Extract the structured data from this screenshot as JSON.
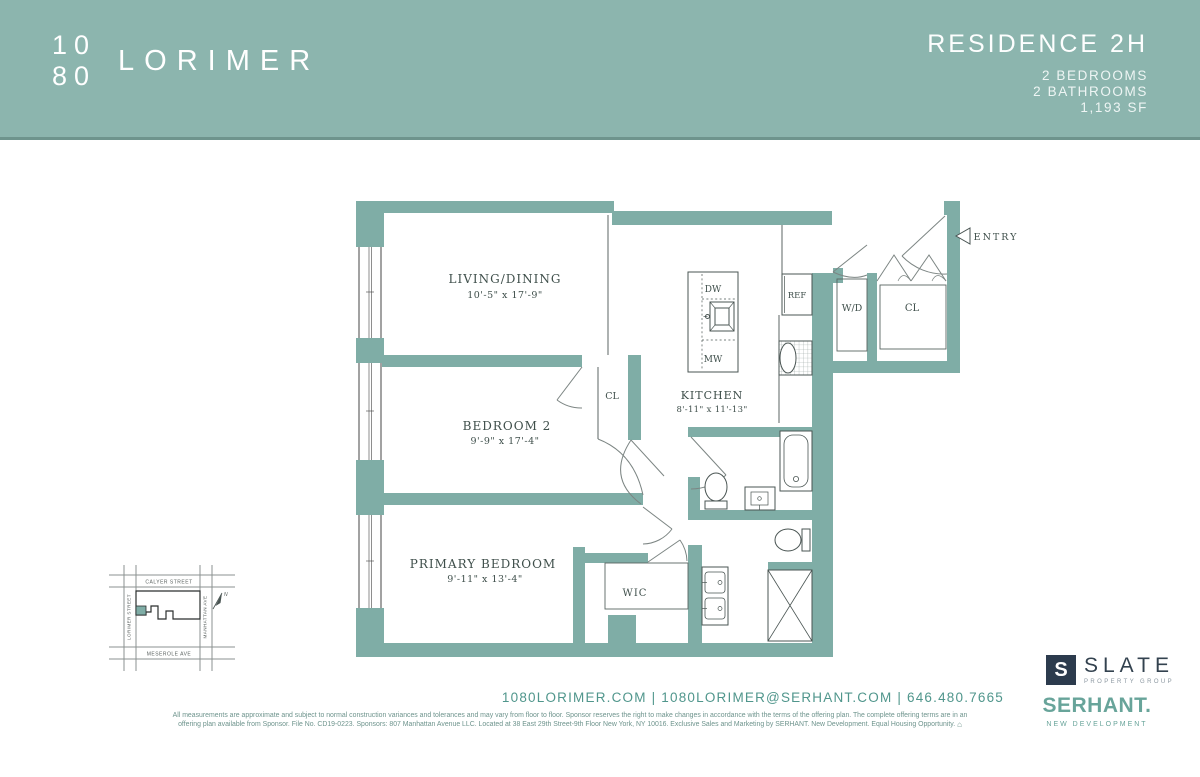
{
  "header": {
    "logo_line1": "10",
    "logo_line2": "80",
    "logo_name": "LORIMER",
    "residence": "RESIDENCE 2H",
    "details": [
      "2 BEDROOMS",
      "2 BATHROOMS",
      "1,193 SF"
    ]
  },
  "floorplan": {
    "rooms": {
      "living": {
        "label": "LIVING/DINING",
        "dims": "10'-5\" x 17'-9\""
      },
      "bedroom2": {
        "label": "BEDROOM 2",
        "dims": "9'-9\" x 17'-4\""
      },
      "primary": {
        "label": "PRIMARY BEDROOM",
        "dims": "9'-11\" x 13'-4\""
      },
      "kitchen": {
        "label": "KITCHEN",
        "dims": "8'-11\" x 11'-13\""
      }
    },
    "tags": {
      "wic": "WIC",
      "cl_bedroom": "CL",
      "cl_entry": "CL",
      "wd": "W/D",
      "ref": "REF",
      "dw": "DW",
      "mw": "MW",
      "entry": "ENTRY"
    }
  },
  "map": {
    "streets": {
      "top": "CALYER STREET",
      "bottom": "MESEROLE AVE",
      "left": "LORIMER STREET",
      "right": "MANHATTAN AVE"
    },
    "north": "N"
  },
  "footer": {
    "contact": "1080LORIMER.COM   |   1080LORIMER@SERHANT.COM   |   646.480.7665",
    "disclaimer_line1": "All measurements are approximate and subject to normal construction variances and tolerances and may vary from floor to floor. Sponsor reserves the right to make changes in accordance with the terms of the offering plan. The complete offering terms are in an",
    "disclaimer_line2": "offering plan available from Sponsor. File No. CD19-0223. Sponsors: 807 Manhattan Avenue LLC. Located at 38 East 29th Street-9th Floor New York, NY 10016. Exclusive Sales and Marketing by SERHANT. New Development. Equal Housing Opportunity.",
    "slate_initial": "S",
    "slate_name": "SLATE",
    "slate_sub": "PROPERTY GROUP",
    "serhant_name": "SERHANT.",
    "serhant_sub": "NEW DEVELOPMENT"
  },
  "colors": {
    "header_bg": "#8cb5ae",
    "header_rule": "#6e948d",
    "wall_teal": "#7fada6",
    "plan_text": "#3f4f4b",
    "contact_teal": "#50968c",
    "slate_navy": "#2c3b4d",
    "serhant_teal": "#68a49a"
  }
}
